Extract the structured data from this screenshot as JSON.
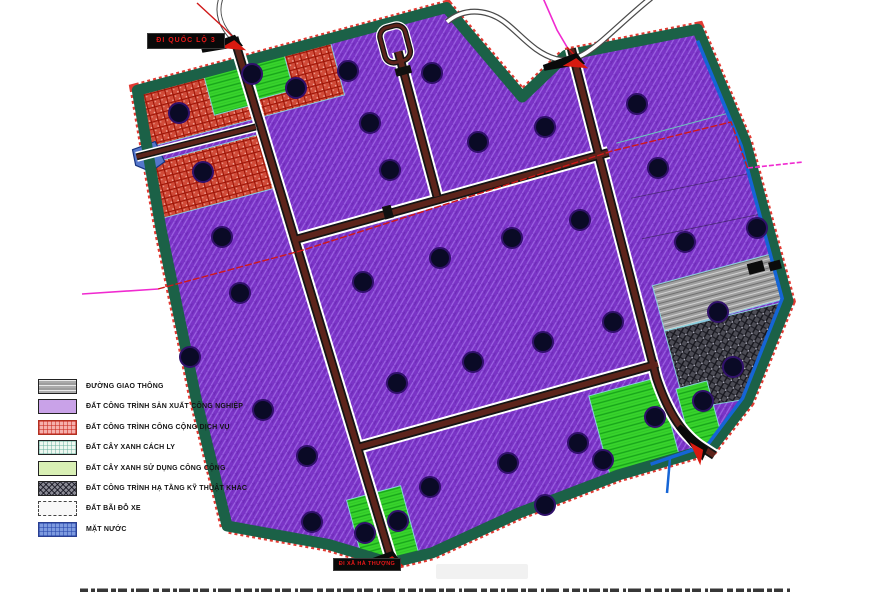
{
  "title": "Industrial zone land-use planning map",
  "legend": {
    "items": [
      {
        "key": "duong-giao-thong",
        "label": "ĐƯỜNG GIAO THÔNG",
        "color": "#b9b9b9"
      },
      {
        "key": "dat-san-xuat-cong-nghiep",
        "label": "ĐẤT CÔNG TRÌNH SẢN XUẤT CÔNG NGHIỆP",
        "color": "#c9a2e8"
      },
      {
        "key": "dat-cong-cong-dich-vu",
        "label": "ĐẤT CÔNG TRÌNH CÔNG CỘNG DỊCH VỤ",
        "color": "#f2a8a2"
      },
      {
        "key": "dat-cay-xanh-cach-ly",
        "label": "ĐẤT CÂY XANH CÁCH LY",
        "color": "#e9f6ee"
      },
      {
        "key": "dat-cay-xanh-cong-cong",
        "label": "ĐẤT CÂY XANH SỬ DỤNG CÔNG CỘNG",
        "color": "#d9f0b5"
      },
      {
        "key": "dat-ha-tang-ky-thuat",
        "label": "ĐẤT CÔNG TRÌNH HẠ TẦNG KỸ THUẬT KHÁC",
        "color": "#6f6f78"
      },
      {
        "key": "dat-bai-do-xe",
        "label": "ĐẤT BÃI ĐỖ XE",
        "color": "#f6f6f6"
      },
      {
        "key": "mat-nuoc",
        "label": "MẶT NƯỚC",
        "color": "#7d9ade"
      }
    ]
  },
  "labels": {
    "to_highway": "ĐI QUỐC LỘ 3",
    "to_commune": "ĐI XÃ HÀ THƯỢNG"
  },
  "colors": {
    "industrial_purple": "#7a33c6",
    "public_service_red": "#d04a38",
    "public_green": "#38d42c",
    "isolation_buffer_green": "#1b6147",
    "road_asphalt": "#5d241b",
    "road_casing": "#ffffff",
    "gray_parcel": "#9f9f9f",
    "technical_dark": "#4c4c55",
    "water_blue": "#5577cc",
    "channel_blue": "#1565d6",
    "boundary_red": "#d01818",
    "survey_magenta": "#f02ad0"
  },
  "map": {
    "rotation_deg": -15,
    "dots": [
      [
        179,
        113
      ],
      [
        252,
        74
      ],
      [
        296,
        88
      ],
      [
        348,
        71
      ],
      [
        432,
        73
      ],
      [
        370,
        123
      ],
      [
        478,
        142
      ],
      [
        545,
        127
      ],
      [
        637,
        104
      ],
      [
        203,
        172
      ],
      [
        390,
        170
      ],
      [
        658,
        168
      ],
      [
        685,
        242
      ],
      [
        222,
        237
      ],
      [
        240,
        293
      ],
      [
        190,
        357
      ],
      [
        263,
        410
      ],
      [
        307,
        456
      ],
      [
        363,
        282
      ],
      [
        440,
        258
      ],
      [
        512,
        238
      ],
      [
        580,
        220
      ],
      [
        397,
        383
      ],
      [
        473,
        362
      ],
      [
        543,
        342
      ],
      [
        613,
        322
      ],
      [
        718,
        312
      ],
      [
        733,
        367
      ],
      [
        757,
        228
      ],
      [
        312,
        522
      ],
      [
        365,
        533
      ],
      [
        398,
        521
      ],
      [
        430,
        487
      ],
      [
        508,
        463
      ],
      [
        578,
        443
      ],
      [
        545,
        505
      ],
      [
        655,
        417
      ],
      [
        703,
        401
      ],
      [
        603,
        460
      ]
    ],
    "gates": [
      {
        "x": 235,
        "y": 43,
        "a": -15
      },
      {
        "x": 577,
        "y": 61,
        "a": -15
      },
      {
        "x": 393,
        "y": 559,
        "a": -15
      },
      {
        "x": 701,
        "y": 452,
        "a": 45
      }
    ]
  }
}
